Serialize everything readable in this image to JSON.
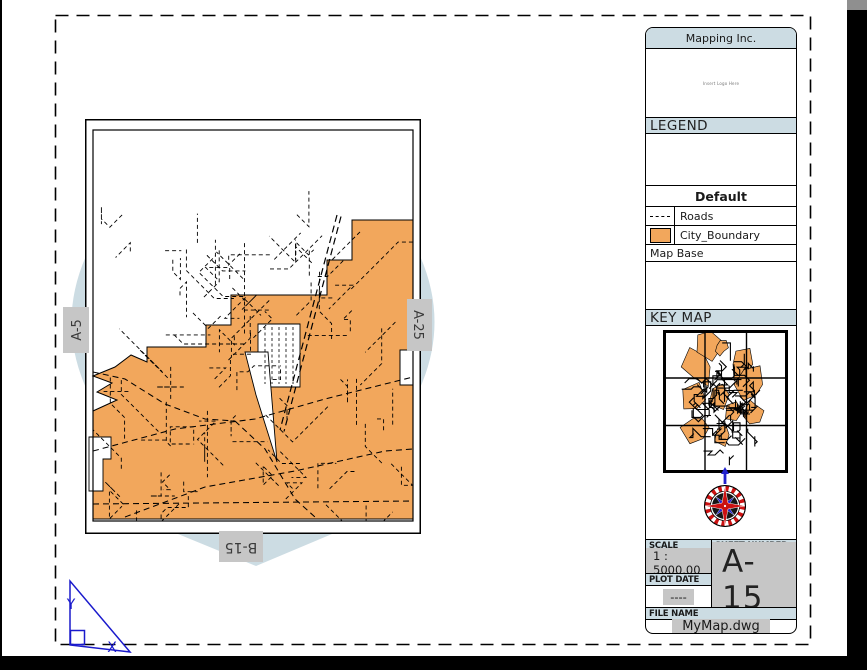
{
  "titleblock": {
    "company": "Mapping Inc.",
    "logo_placeholder": "Insert Logo Here",
    "legend": {
      "title": "LEGEND",
      "group": "Default",
      "items": [
        {
          "label": "Roads",
          "symbol": "dashed-line"
        },
        {
          "label": "City_Boundary",
          "symbol": "orange-fill",
          "color": "#F2A75C"
        }
      ],
      "base_label": "Map Base"
    },
    "keymap": {
      "title": "KEY MAP"
    },
    "scale": {
      "label": "SCALE",
      "value": "1 : 5000.00"
    },
    "sheet": {
      "label": "SHEET NUMBER",
      "value": "A-15"
    },
    "plot_date": {
      "label": "PLOT DATE",
      "value": "----"
    },
    "file": {
      "label": "FILE NAME",
      "value": "MyMap.dwg"
    }
  },
  "map": {
    "adjacent_sheets": {
      "left": "A-5",
      "right": "A-25",
      "bottom": "B-15"
    },
    "ucs": {
      "x_label": "X",
      "y_label": "Y"
    },
    "colors": {
      "city_boundary": "#F2A75C",
      "section_header_bg": "#CCDCE3",
      "label_bg": "#C6C6C6",
      "ucs_blue": "#1A1ACC",
      "compass_red": "#CC1111",
      "compass_blue": "#2222CC"
    },
    "geometry": {
      "boundary": [
        [
          328,
          101
        ],
        [
          267,
          101
        ],
        [
          267,
          141
        ],
        [
          242,
          141
        ],
        [
          242,
          176
        ],
        [
          146,
          176
        ],
        [
          146,
          206
        ],
        [
          121,
          206
        ],
        [
          121,
          228
        ],
        [
          62,
          228
        ],
        [
          62,
          243
        ],
        [
          46,
          236
        ],
        [
          30,
          248
        ],
        [
          8,
          257
        ],
        [
          27,
          264
        ],
        [
          12,
          273
        ],
        [
          32,
          281
        ],
        [
          8,
          292
        ],
        [
          8,
          400
        ],
        [
          328,
          400
        ],
        [
          328,
          266
        ],
        [
          315,
          266
        ],
        [
          315,
          231
        ],
        [
          328,
          231
        ]
      ],
      "holes": [
        [
          [
            173,
            205
          ],
          [
            215,
            205
          ],
          [
            215,
            268
          ],
          [
            173,
            268
          ]
        ],
        [
          [
            160,
            233
          ],
          [
            183,
            233
          ],
          [
            192,
            343
          ],
          [
            171,
            276
          ]
        ],
        [
          [
            4,
            318
          ],
          [
            26,
            318
          ],
          [
            26,
            340
          ],
          [
            18,
            340
          ],
          [
            18,
            372
          ],
          [
            4,
            372
          ]
        ]
      ],
      "major_roads": [
        [
          [
            8,
            332
          ],
          [
            90,
            310
          ],
          [
            170,
            300
          ],
          [
            240,
            280
          ],
          [
            328,
            258
          ]
        ],
        [
          [
            8,
            253
          ],
          [
            40,
            260
          ],
          [
            80,
            285
          ],
          [
            120,
            300
          ],
          [
            150,
            302
          ]
        ],
        [
          [
            40,
            398
          ],
          [
            120,
            368
          ],
          [
            210,
            352
          ],
          [
            300,
            332
          ],
          [
            328,
            330
          ]
        ],
        [
          [
            8,
            385
          ],
          [
            328,
            382
          ]
        ],
        [
          [
            150,
            302
          ],
          [
            180,
            330
          ],
          [
            210,
            380
          ],
          [
            230,
            398
          ]
        ]
      ],
      "highway": {
        "from": [
          252,
          96
        ],
        "to": [
          195,
          311
        ],
        "gap": 4
      },
      "road_regions": [
        {
          "x": 35,
          "y": 90,
          "w": 180,
          "h": 95,
          "count": 22,
          "seed": 7
        },
        {
          "x": 15,
          "y": 185,
          "w": 305,
          "h": 210,
          "count": 60,
          "seed": 13
        },
        {
          "x": 215,
          "y": 140,
          "w": 60,
          "h": 45,
          "count": 7,
          "seed": 3
        }
      ]
    },
    "keymap_gen": {
      "blob_seed": 21,
      "blob_count": 11,
      "squiggle_seed": 5,
      "squiggle_count": 58
    }
  }
}
